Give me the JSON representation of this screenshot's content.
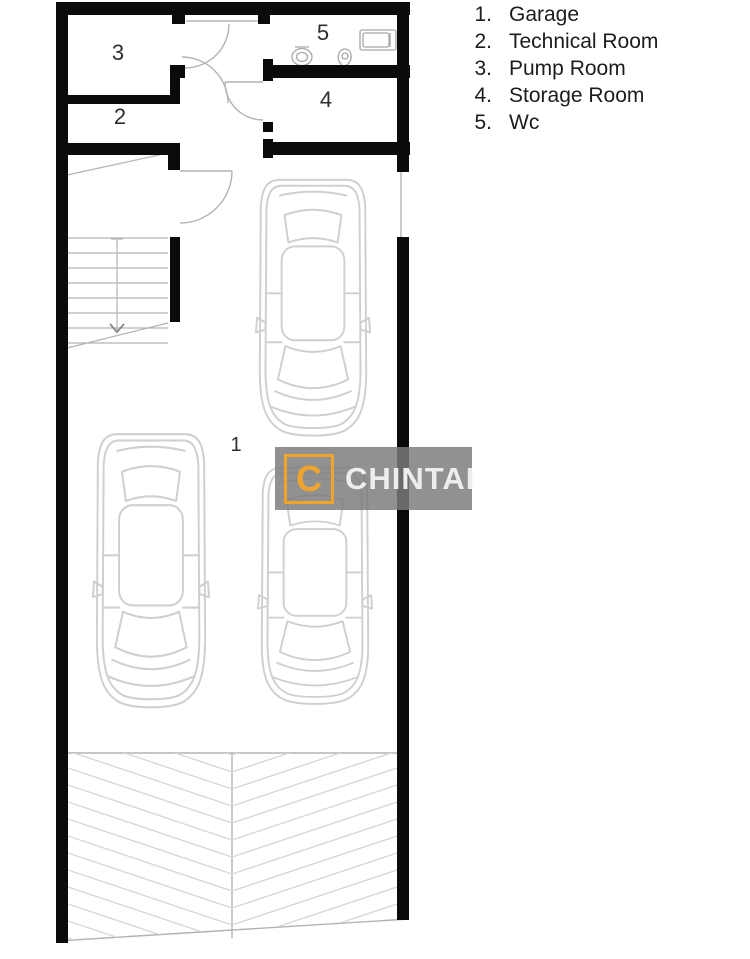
{
  "legend": {
    "items": [
      {
        "num": "1.",
        "label": "Garage"
      },
      {
        "num": "2.",
        "label": "Technical Room"
      },
      {
        "num": "3.",
        "label": "Pump Room"
      },
      {
        "num": "4.",
        "label": "Storage Room"
      },
      {
        "num": "5.",
        "label": "Wc"
      }
    ]
  },
  "watermark": {
    "letter": "C",
    "brand": "CHINTAI",
    "accent_color": "#F0A42E",
    "panel_color": "rgba(124,124,124,0.84)",
    "text_color": "#ededed"
  },
  "plan": {
    "colors": {
      "wall": "#0b0b0b",
      "thin": "#b3b3b3",
      "car": "#cfcfcf",
      "hatch": "#d8d8d8",
      "fixture": "#a6a6a6",
      "label": "#2e2e2e"
    },
    "walls": [
      [
        56,
        2,
        12,
        941
      ],
      [
        56,
        2,
        354,
        13
      ],
      [
        397,
        2,
        12,
        170
      ],
      [
        397,
        237,
        12,
        683
      ],
      [
        263,
        65,
        147,
        13
      ],
      [
        263,
        59,
        10,
        22
      ],
      [
        263,
        142,
        147,
        13
      ],
      [
        263,
        139,
        10,
        19
      ],
      [
        263,
        122,
        10,
        10
      ],
      [
        172,
        13,
        13,
        11
      ],
      [
        258,
        13,
        12,
        11
      ],
      [
        170,
        65,
        15,
        13
      ],
      [
        170,
        65,
        10,
        38
      ],
      [
        56,
        95,
        124,
        9
      ],
      [
        56,
        143,
        112,
        12
      ],
      [
        168,
        143,
        12,
        27
      ],
      [
        170,
        237,
        10,
        85
      ]
    ],
    "thin_lines": [
      [
        186,
        21,
        258,
        21
      ],
      [
        401,
        172,
        401,
        237
      ],
      [
        180,
        171,
        232,
        171
      ],
      [
        225,
        82,
        263,
        82
      ],
      [
        68,
        753,
        397,
        753
      ],
      [
        232,
        753,
        232,
        938
      ],
      [
        57,
        941,
        409,
        919
      ]
    ],
    "arcs": [
      "M229,24 A44,44 0 0 1 185,68",
      "M182,57 A46,46 0 0 1 228,103",
      "M225,82 A38,38 0 0 0 263,120",
      "M232,171 A52,52 0 0 1 180,223"
    ],
    "labels": [
      {
        "text": "3",
        "x": 118,
        "y": 60,
        "size": 22
      },
      {
        "text": "2",
        "x": 120,
        "y": 124,
        "size": 22
      },
      {
        "text": "5",
        "x": 323,
        "y": 40,
        "size": 22
      },
      {
        "text": "4",
        "x": 326,
        "y": 107,
        "size": 22
      },
      {
        "text": "1",
        "x": 236,
        "y": 451,
        "size": 20
      }
    ],
    "fixtures": {
      "ellipses": [
        [
          302,
          57,
          10,
          8.5
        ],
        [
          302,
          57,
          5.5,
          4.5
        ]
      ],
      "rects": [
        [
          360,
          30,
          36,
          20
        ],
        [
          363,
          33,
          26,
          14
        ]
      ],
      "lines": [
        [
          390,
          33,
          390,
          47
        ],
        [
          295,
          47,
          309,
          47
        ]
      ],
      "paths": [
        "M345,49 C352,49 353,59 348,64 C345,67 343,67 341,64 C336,59 338,49 345,49 Z",
        "M342,56 a3,3 0 1 0 6,0 a3,3 0 1 0 -6,0"
      ]
    },
    "stairs": {
      "x1": 67,
      "x2": 168,
      "y_first": 238,
      "step": 15,
      "count": 8,
      "center_x": 117,
      "line_y1": 239,
      "line_y2": 332,
      "arrow": "110,324 117,332 124,324",
      "tick": [
        111,
        239,
        123,
        239
      ],
      "diagonals": [
        [
          67,
          175,
          168,
          153
        ],
        [
          67,
          348,
          168,
          323
        ]
      ]
    },
    "hatch": {
      "clip": "68,753 397,753 397,919 57,941",
      "x_left": 68,
      "x_mid": 232,
      "x_right": 397,
      "y_start": 700,
      "spacing": 17,
      "drop": 55,
      "count": 15
    },
    "cars": [
      {
        "x": 256,
        "y": 176,
        "w": 114,
        "h": 264
      },
      {
        "x": 93,
        "y": 430,
        "w": 116,
        "h": 282
      },
      {
        "x": 258,
        "y": 464,
        "w": 114,
        "h": 244
      }
    ]
  }
}
